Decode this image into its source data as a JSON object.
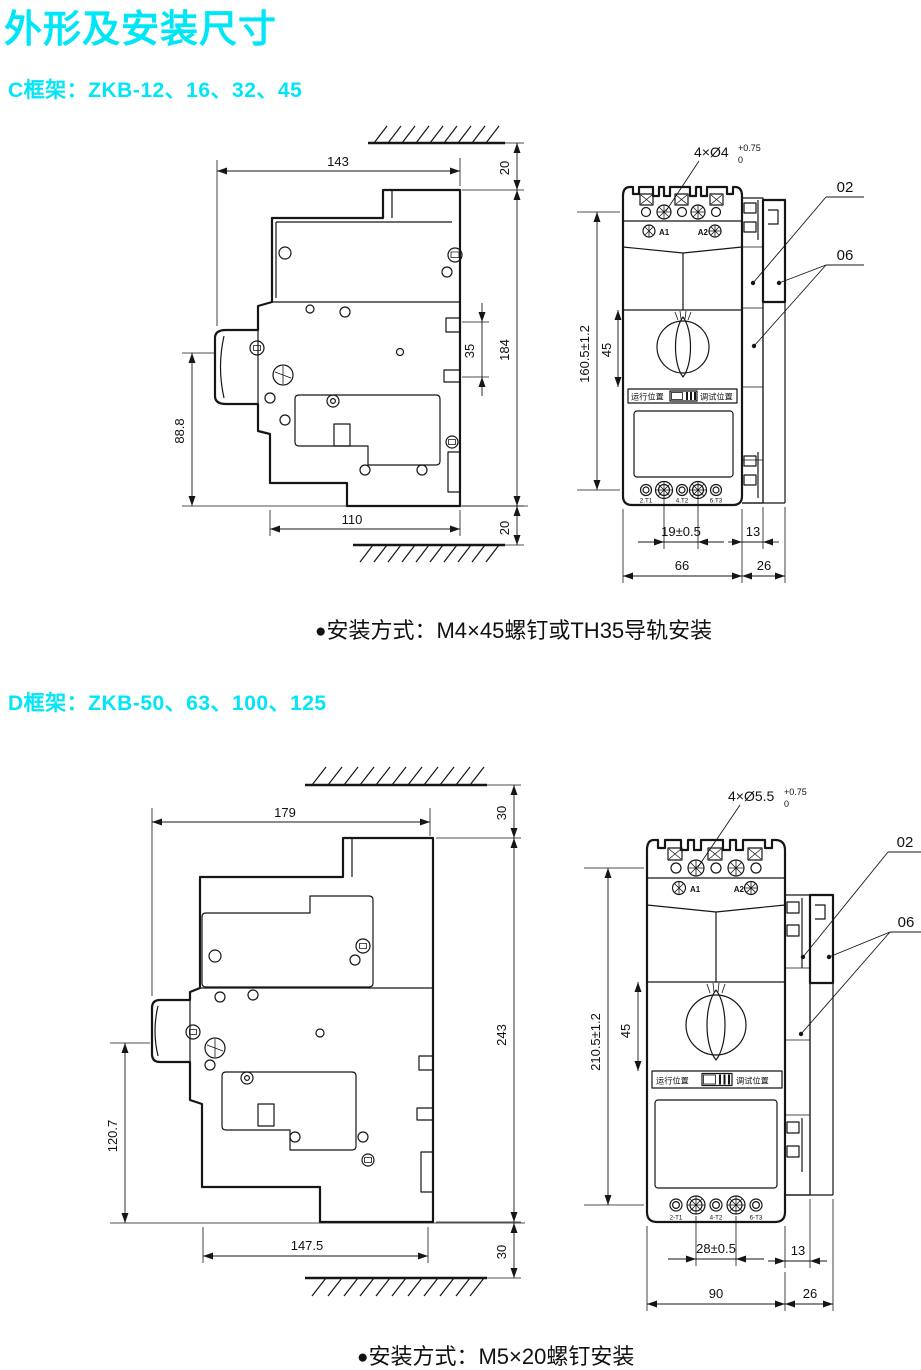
{
  "page": {
    "title": "外形及安装尺寸"
  },
  "c": {
    "header": "C框架：ZKB-12、16、32、45",
    "bullet": "●",
    "note": "安装方式：M4×45螺钉或TH35导轨安装",
    "side": {
      "w_top": "143",
      "gap_top": "20",
      "h_total": "184",
      "rail": "35",
      "h_lower": "88.8",
      "w_bottom": "110",
      "gap_bottom": "20"
    },
    "front": {
      "holes": "4×Ø4",
      "tol_up": "+0.75",
      "tol_dn": "0",
      "ref02": "02",
      "ref06": "06",
      "h_total": "160.5±1.2",
      "knob": "45",
      "pitch": "19±0.5",
      "rail_w": "13",
      "w_body": "66",
      "w_side": "26",
      "a1": "A1",
      "a2": "A2",
      "run": "运行位置",
      "test": "调试位置",
      "t1": "2.T1",
      "t2": "4.T2",
      "t3": "6.T3"
    }
  },
  "d": {
    "header": "D框架：ZKB-50、63、100、125",
    "bullet": "●",
    "note": "安装方式：M5×20螺钉安装",
    "side": {
      "w_top": "179",
      "gap_top": "30",
      "h_total": "243",
      "h_lower": "120.7",
      "w_bottom": "147.5",
      "gap_bottom": "30"
    },
    "front": {
      "holes": "4×Ø5.5",
      "tol_up": "+0.75",
      "tol_dn": "0",
      "ref02": "02",
      "ref06": "06",
      "h_total": "210.5±1.2",
      "knob": "45",
      "pitch": "28±0.5",
      "rail_w": "13",
      "w_body": "90",
      "w_side": "26",
      "a1": "A1",
      "a2": "A2",
      "run": "运行位置",
      "test": "调试位置",
      "t1": "2-T1",
      "t2": "4-T2",
      "t3": "6-T3"
    }
  }
}
